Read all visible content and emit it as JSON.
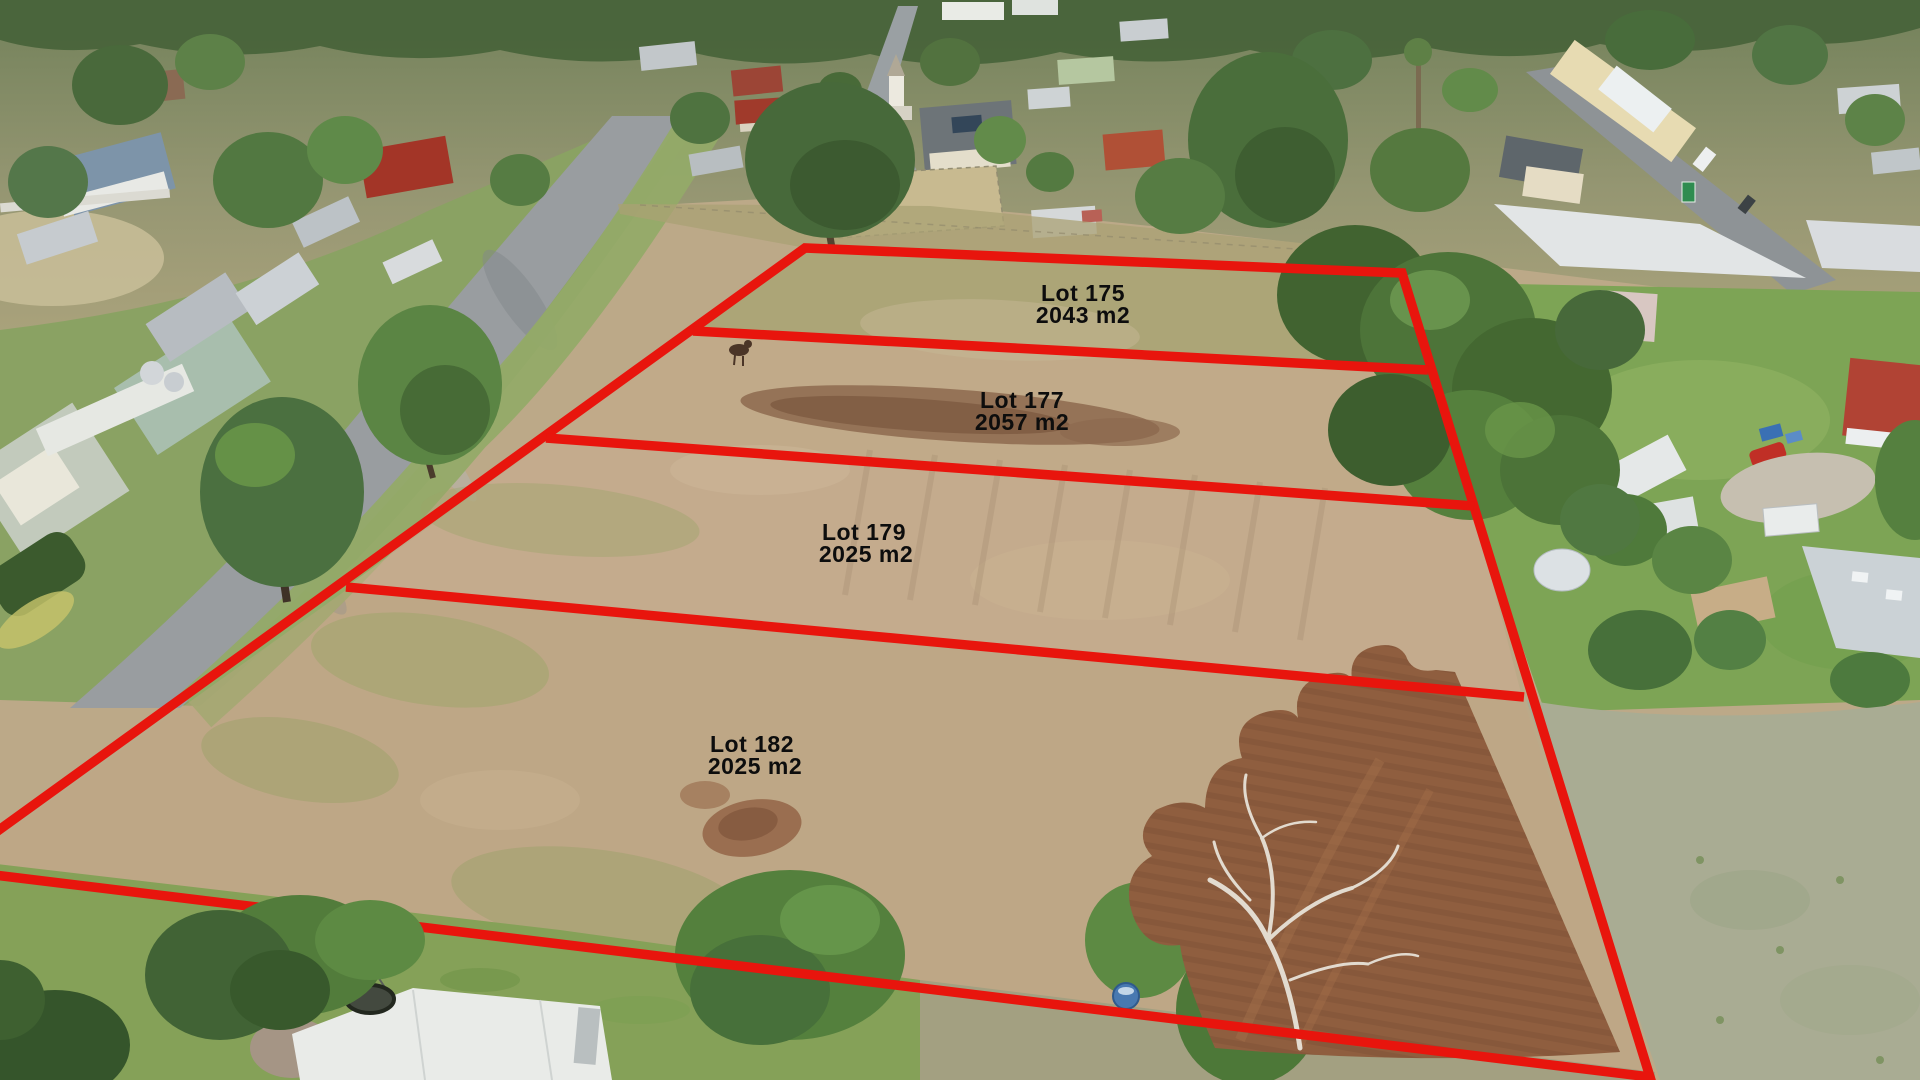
{
  "image": {
    "kind": "aerial-drone-photo",
    "subject": "Country-town residential land subdivision: four vacant lots outlined in red over a dry paddock"
  },
  "overlay": {
    "boundary_color": "#e8150d",
    "label_color": "#0d0d0d"
  },
  "lots": [
    {
      "name": "Lot 175",
      "area": "2043 m2"
    },
    {
      "name": "Lot 177",
      "area": "2057 m2"
    },
    {
      "name": "Lot 179",
      "area": "2025 m2"
    },
    {
      "name": "Lot 182",
      "area": "2025 m2"
    }
  ]
}
